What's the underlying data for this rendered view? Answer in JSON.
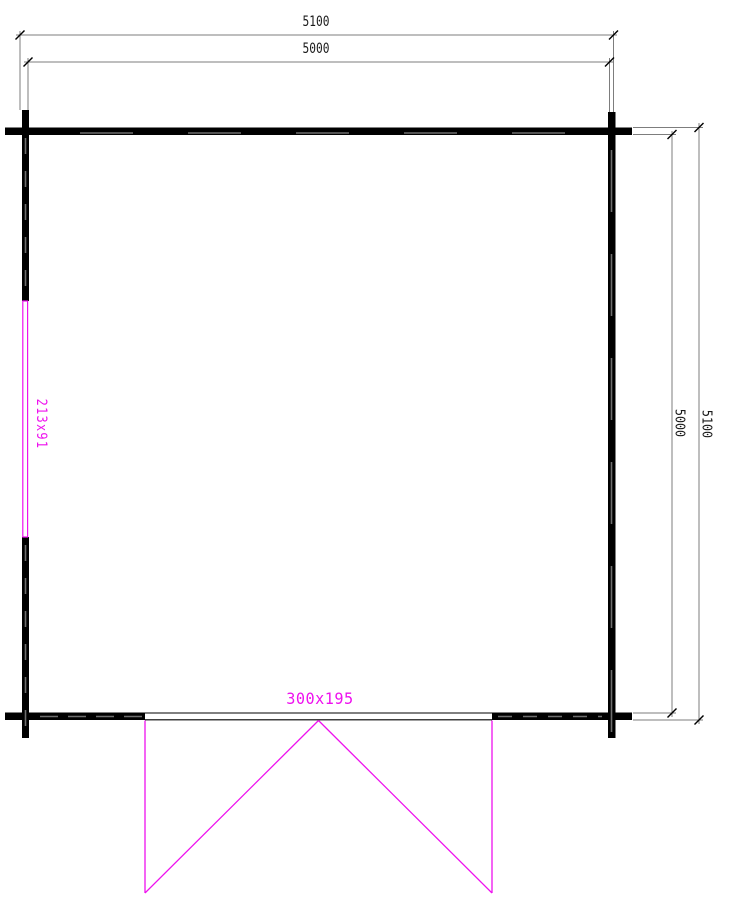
{
  "plan": {
    "dimensions": {
      "top_outer": "5100",
      "top_inner": "5000",
      "right_inner": "5000",
      "right_outer": "5100"
    },
    "openings": {
      "window_label": "213x91",
      "door_label": "300x195"
    },
    "colors": {
      "wall": "#000000",
      "dimension_line": "#7d7d7d",
      "joint_dash": "#6e6e6e",
      "opening_magenta": "#ee11ee",
      "text": "#1a1a1a"
    }
  }
}
